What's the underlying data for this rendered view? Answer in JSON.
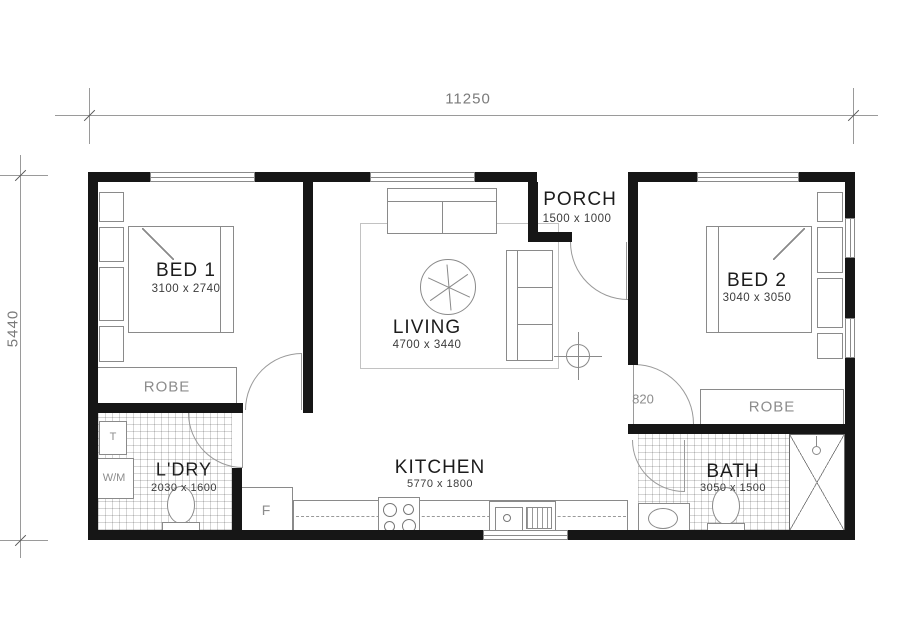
{
  "drawing_title": "Single storey floor plan",
  "dims": {
    "overall_width": "11250",
    "overall_height": "5440",
    "door_opening": "820"
  },
  "rooms": {
    "bed1": {
      "label": "BED 1",
      "size": "3100 x 2740"
    },
    "living": {
      "label": "LIVING",
      "size": "4700 x 3440"
    },
    "porch": {
      "label": "PORCH",
      "size": "1500 x 1000"
    },
    "bed2": {
      "label": "BED 2",
      "size": "3040 x 3050"
    },
    "ldry": {
      "label": "L'DRY",
      "size": "2030 x 1600"
    },
    "kitchen": {
      "label": "KITCHEN",
      "size": "5770 x 1800"
    },
    "bath": {
      "label": "BATH",
      "size": "3050 x 1500"
    }
  },
  "fixtures": {
    "robe1": "ROBE",
    "robe2": "ROBE",
    "washing_machine": "W/M",
    "laundry_tub": "T",
    "fridge": "F"
  },
  "colors": {
    "wall": "#161616",
    "furniture_line": "#8a8a8a",
    "dimension_line": "#9a9a9a",
    "label_text": "#1c1c1c",
    "muted_text": "#8c8c8c",
    "background": "#ffffff"
  }
}
